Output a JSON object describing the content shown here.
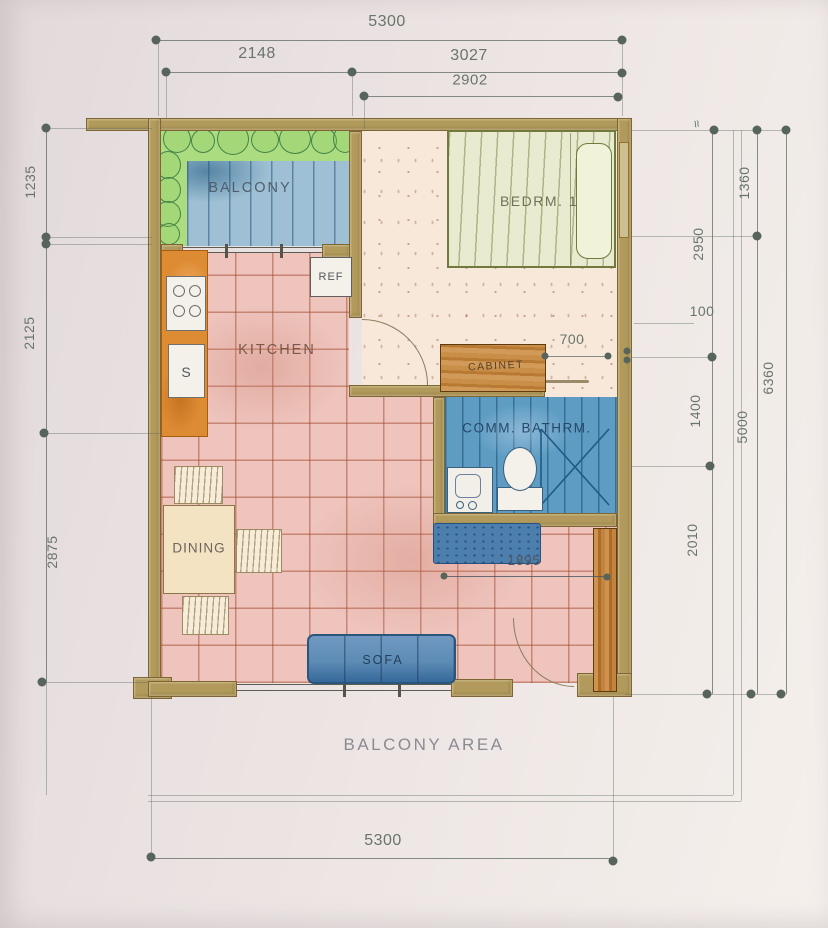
{
  "labels": {
    "balcony": "BALCONY",
    "bedroom": "BEDRM. 1",
    "kitchen": "KITCHEN",
    "ref": "REF",
    "sink": "S",
    "cabinet": "CABINET",
    "bathroom": "COMM. BATHRM.",
    "dining": "DINING",
    "sofa": "SOFA",
    "balcony_area": "BALCONY AREA"
  },
  "dimensions": {
    "top_total": "5300",
    "top_left": "2148",
    "top_right": "3027",
    "top_right_inner": "2902",
    "left_upper": "1235",
    "left_middle": "2125",
    "left_lower": "2875",
    "right_upper_inner": "2950",
    "right_wall_thickness": "100",
    "right_mid_inner": "1400",
    "right_lower_inner": "2010",
    "right_upper_outer": "1360",
    "right_lower_outer": "5000",
    "right_total": "6360",
    "bathroom_door": "700",
    "bed_width": "1895",
    "bottom_total": "5300"
  },
  "colors": {
    "wall_tan": "#b19a5c",
    "floor_pink": "#eec4bd",
    "bathroom_blue": "#5e9cc3",
    "balcony_blue": "#9fc0d4",
    "plant_green": "#abdc7f",
    "counter_orange": "#de8c34",
    "cabinet_wood": "#c98f49",
    "dimension_gray": "#68746c"
  }
}
